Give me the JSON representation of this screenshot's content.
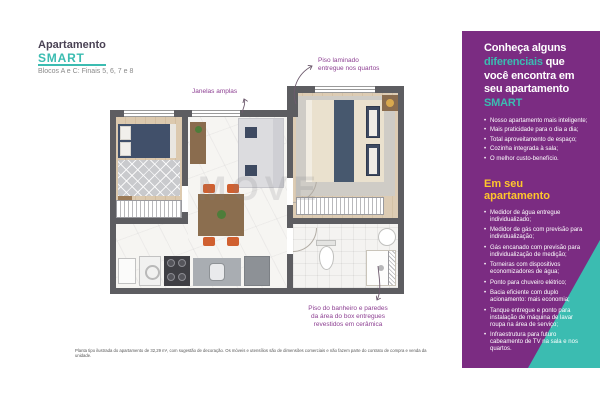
{
  "header": {
    "kicker": "Apartamento",
    "brand": "SMART",
    "subtitle": "Blocos A e C: Finais 5, 6, 7 e 8"
  },
  "plan": {
    "watermark": "MOVE",
    "labels": {
      "windows": "Janelas amplas",
      "laminate": "Piso laminado\nentregue nos quartos",
      "bathroom": "Piso do banheiro e paredes\nda área do box entregues\nrevestidos em cerâmica"
    }
  },
  "disclaimer": "Planta tipo ilustrada do apartamento de 32,29 m², com sugestão de decoração. Os móveis e utensílios são de dimensões comerciais e não fazem parte do contrato de compra e venda da unidade.",
  "panel": {
    "title": {
      "l1": "Conheça alguns",
      "l2a": "diferenciais",
      "l2b": " que",
      "l3": "você encontra em",
      "l4": "seu apartamento",
      "l5": "SMART"
    },
    "list1": [
      "Nosso apartamento mais inteligente;",
      "Mais praticidade para o dia a dia;",
      "Total aproveitamento de espaço;",
      "Cozinha integrada à sala;",
      "O melhor custo-benefício."
    ],
    "section2_heading": "Em seu apartamento",
    "list2": [
      "Medidor de água entregue individualizado;",
      "Medidor de gás com previsão para individualização;",
      "Gás encanado com previsão para individualização de medição;",
      "Torneiras com dispositivos economizadores de água;",
      "Ponto para chuveiro elétrico;",
      "Bacia eficiente com duplo acionamento: mais economia;",
      "Tanque entregue e ponto para instalação de máquina de lavar roupa na área de serviço;",
      "Infraestrutura para futuro cabeamento de TV na sala e nos quartos."
    ]
  },
  "colors": {
    "teal_accent": "#3bbcb1",
    "panel_purple": "#7b2c82",
    "highlight_yellow": "#ffc62b",
    "label_purple": "#8d3f92",
    "wall_gray": "#5d5d61"
  }
}
